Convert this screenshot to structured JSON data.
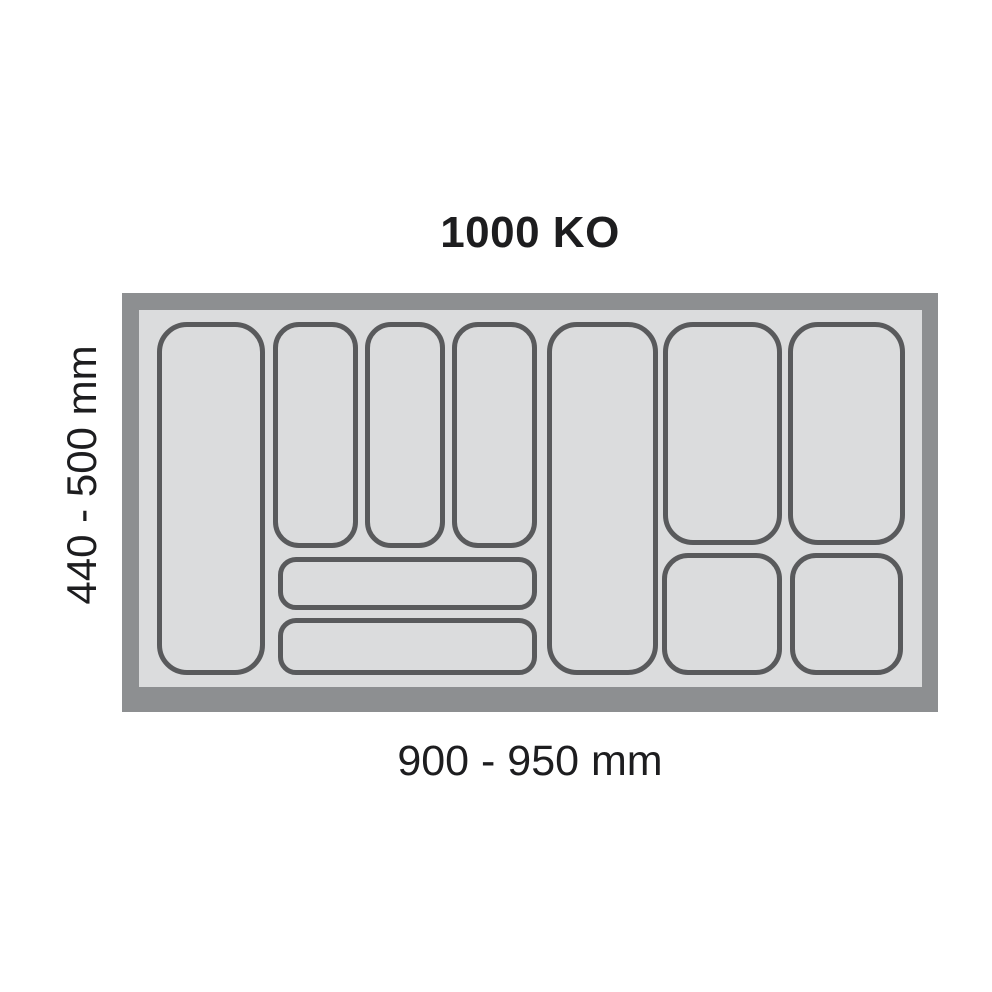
{
  "title": "1000 KO",
  "dimensions": {
    "width_label": "900 - 950 mm",
    "height_label": "440 - 500 mm"
  },
  "colors": {
    "background": "#ffffff",
    "frame": "#8d8f91",
    "tray_base": "#dbdcdd",
    "compartment_fill": "#dbdcdd",
    "compartment_stroke": "#595a5c",
    "text": "#1d1d1f"
  },
  "tray": {
    "frame_thickness_px": 17,
    "compartments": [
      {
        "name": "compartment-left-tall",
        "x": 35,
        "y": 29,
        "w": 108,
        "h": 353,
        "r": 30
      },
      {
        "name": "compartment-narrow-1",
        "x": 151,
        "y": 29,
        "w": 85,
        "h": 226,
        "r": 26
      },
      {
        "name": "compartment-narrow-2",
        "x": 243,
        "y": 29,
        "w": 80,
        "h": 226,
        "r": 26
      },
      {
        "name": "compartment-narrow-3",
        "x": 330,
        "y": 29,
        "w": 85,
        "h": 226,
        "r": 26
      },
      {
        "name": "compartment-wide-upper",
        "x": 156,
        "y": 264,
        "w": 259,
        "h": 53,
        "r": 18
      },
      {
        "name": "compartment-wide-lower",
        "x": 156,
        "y": 325,
        "w": 259,
        "h": 57,
        "r": 18
      },
      {
        "name": "compartment-middle-tall",
        "x": 425,
        "y": 29,
        "w": 111,
        "h": 353,
        "r": 30
      },
      {
        "name": "compartment-right-tall-1",
        "x": 541,
        "y": 29,
        "w": 119,
        "h": 223,
        "r": 30
      },
      {
        "name": "compartment-right-tall-2",
        "x": 666,
        "y": 29,
        "w": 117,
        "h": 223,
        "r": 30
      },
      {
        "name": "compartment-right-small-1",
        "x": 540,
        "y": 260,
        "w": 120,
        "h": 122,
        "r": 26
      },
      {
        "name": "compartment-right-small-2",
        "x": 668,
        "y": 260,
        "w": 113,
        "h": 122,
        "r": 26
      }
    ]
  }
}
